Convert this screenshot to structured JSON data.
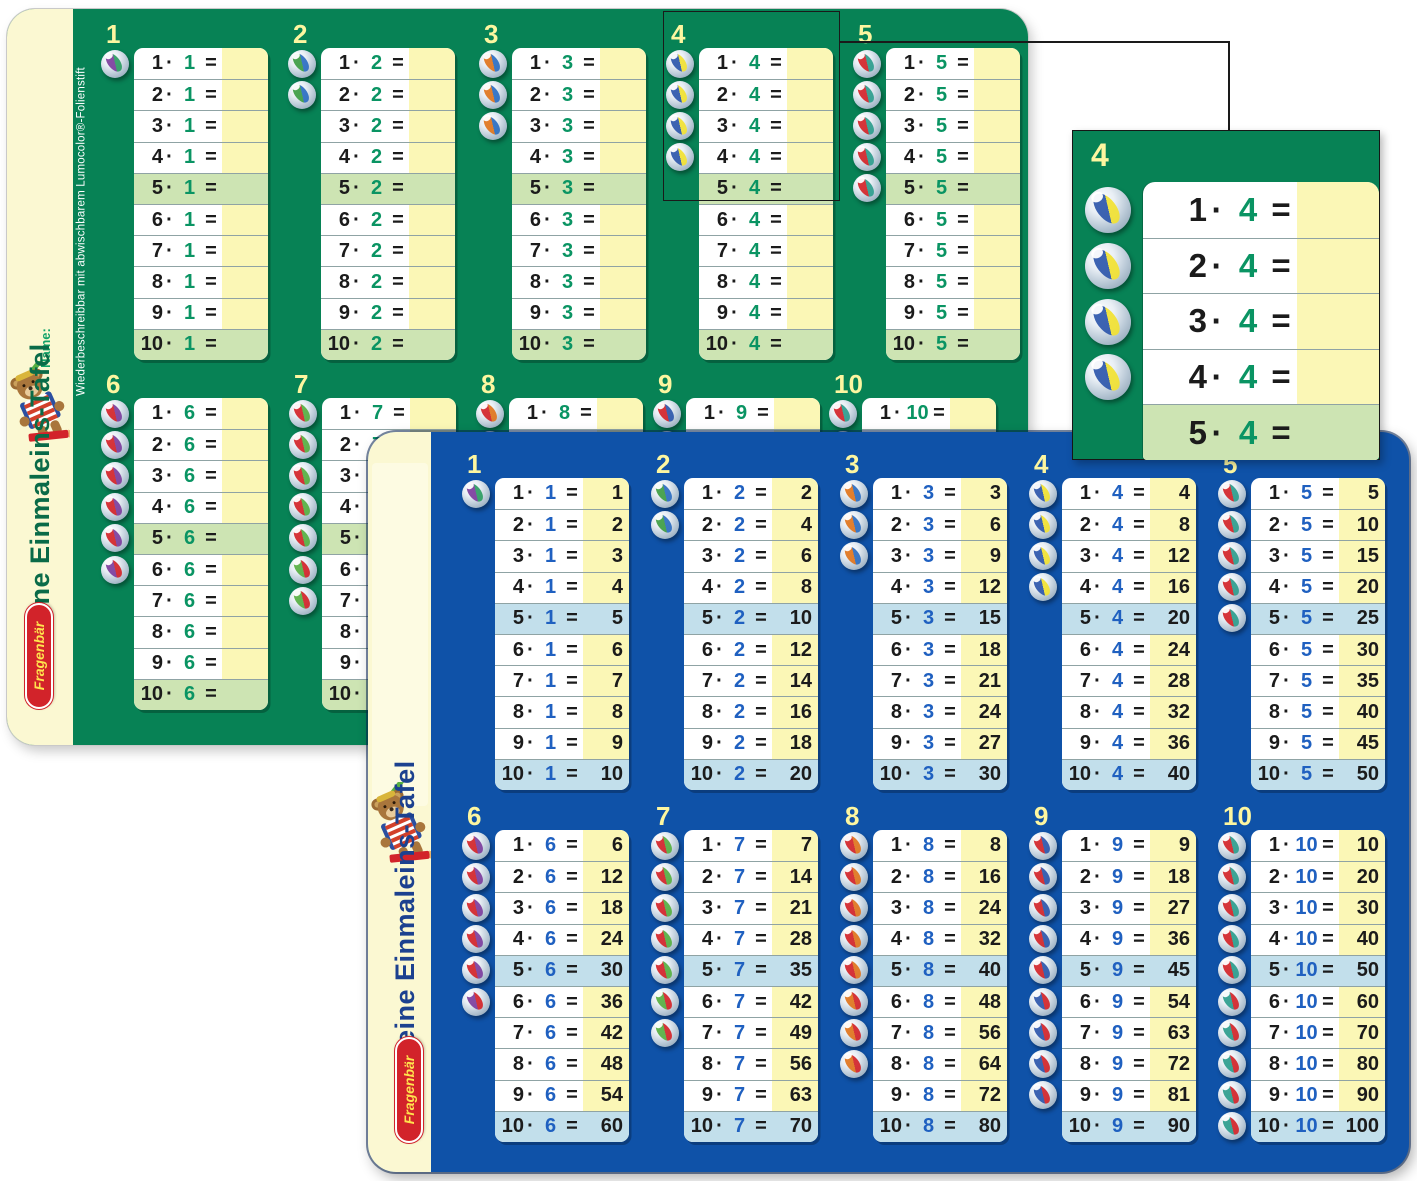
{
  "theme": {
    "green_board_bg": "#078255",
    "blue_board_bg": "#0f52a8",
    "cream_sidebar": "#fbf8d2",
    "answer_cell_yellow": "#fbf7b6",
    "highlight_green": "#cde4b3",
    "highlight_blue": "#c2dfeb",
    "header_number_yellow": "#fdf6a0",
    "factor_green": "#0a9463",
    "factor_blue": "#1f60c0",
    "title_green": "#0a6b48",
    "title_blue": "#1c418f",
    "name_green": "#11a268",
    "logo_red": "#d2232a",
    "logo_text_yellow": "#ffe34d"
  },
  "shared": {
    "operator": "·",
    "equals": "=",
    "multiplicands": [
      "1",
      "2",
      "3",
      "4",
      "5",
      "6",
      "7",
      "8",
      "9",
      "10"
    ],
    "highlighted_multiplicands": [
      "5",
      "10"
    ]
  },
  "green_board": {
    "sidebar": {
      "name_label": "Name:",
      "title": "Kleine Einmaleins-Tafel",
      "logo": "Fragenbär"
    },
    "edge_note": "Wiederbeschreibbar mit abwischbarem Lumocolor®-Folienstift",
    "columns": [
      {
        "header": "1",
        "factor": "1",
        "marbles": 1,
        "marble_colors": [
          "#7d3f9e",
          "#2f9e64"
        ],
        "products": [
          "",
          "",
          "",
          "",
          "",
          "",
          "",
          "",
          "",
          ""
        ]
      },
      {
        "header": "2",
        "factor": "2",
        "marbles": 2,
        "marble_colors": [
          "#3f9e46",
          "#2e6fc2"
        ],
        "products": [
          "",
          "",
          "",
          "",
          "",
          "",
          "",
          "",
          "",
          ""
        ]
      },
      {
        "header": "3",
        "factor": "3",
        "marbles": 3,
        "marble_colors": [
          "#e0761f",
          "#2e6fc2"
        ],
        "products": [
          "",
          "",
          "",
          "",
          "",
          "",
          "",
          "",
          "",
          ""
        ]
      },
      {
        "header": "4",
        "factor": "4",
        "marbles": 4,
        "marble_colors": [
          "#2f58ac",
          "#f2e233"
        ],
        "products": [
          "",
          "",
          "",
          "",
          "",
          "",
          "",
          "",
          "",
          ""
        ]
      },
      {
        "header": "5",
        "factor": "5",
        "marbles": 5,
        "marble_colors": [
          "#d3262b",
          "#2f9e8e"
        ],
        "products": [
          "",
          "",
          "",
          "",
          "",
          "",
          "",
          "",
          "",
          ""
        ]
      },
      {
        "header": "6",
        "factor": "6",
        "marbles": 6,
        "marble_colors": [
          "#d3262b",
          "#7d3f9e"
        ],
        "products": [
          "",
          "",
          "",
          "",
          "",
          "",
          "",
          "",
          "",
          ""
        ]
      },
      {
        "header": "7",
        "factor": "7",
        "marbles": 7,
        "marble_colors": [
          "#d3262b",
          "#58b043"
        ],
        "products": [
          "",
          "",
          "",
          "",
          "",
          "",
          "",
          "",
          "",
          ""
        ]
      },
      {
        "header": "8",
        "factor": "8",
        "marbles": 8,
        "marble_colors": [
          "#d3262b",
          "#e0761f"
        ],
        "products": [
          "",
          "",
          "",
          "",
          "",
          "",
          "",
          "",
          "",
          ""
        ]
      },
      {
        "header": "9",
        "factor": "9",
        "marbles": 9,
        "marble_colors": [
          "#d3262b",
          "#2f58ac"
        ],
        "products": [
          "",
          "",
          "",
          "",
          "",
          "",
          "",
          "",
          "",
          ""
        ]
      },
      {
        "header": "10",
        "factor": "10",
        "marbles": 10,
        "marble_colors": [
          "#d3262b",
          "#2f9e8e"
        ],
        "products": [
          "",
          "",
          "",
          "",
          "",
          "",
          "",
          "",
          "",
          ""
        ]
      }
    ]
  },
  "blue_board": {
    "sidebar": {
      "title": "Kleine Einmaleins-Tafel",
      "logo": "Fragenbär"
    },
    "columns": [
      {
        "header": "1",
        "factor": "1",
        "marbles": 1,
        "marble_colors": [
          "#7d3f9e",
          "#2f9e64"
        ],
        "products": [
          "1",
          "2",
          "3",
          "4",
          "5",
          "6",
          "7",
          "8",
          "9",
          "10"
        ]
      },
      {
        "header": "2",
        "factor": "2",
        "marbles": 2,
        "marble_colors": [
          "#3f9e46",
          "#2e6fc2"
        ],
        "products": [
          "2",
          "4",
          "6",
          "8",
          "10",
          "12",
          "14",
          "16",
          "18",
          "20"
        ]
      },
      {
        "header": "3",
        "factor": "3",
        "marbles": 3,
        "marble_colors": [
          "#e0761f",
          "#2e6fc2"
        ],
        "products": [
          "3",
          "6",
          "9",
          "12",
          "15",
          "18",
          "21",
          "24",
          "27",
          "30"
        ]
      },
      {
        "header": "4",
        "factor": "4",
        "marbles": 4,
        "marble_colors": [
          "#2f58ac",
          "#f2e233"
        ],
        "products": [
          "4",
          "8",
          "12",
          "16",
          "20",
          "24",
          "28",
          "32",
          "36",
          "40"
        ]
      },
      {
        "header": "5",
        "factor": "5",
        "marbles": 5,
        "marble_colors": [
          "#d3262b",
          "#2f9e8e"
        ],
        "products": [
          "5",
          "10",
          "15",
          "20",
          "25",
          "30",
          "35",
          "40",
          "45",
          "50"
        ]
      },
      {
        "header": "6",
        "factor": "6",
        "marbles": 6,
        "marble_colors": [
          "#d3262b",
          "#7d3f9e"
        ],
        "products": [
          "6",
          "12",
          "18",
          "24",
          "30",
          "36",
          "42",
          "48",
          "54",
          "60"
        ]
      },
      {
        "header": "7",
        "factor": "7",
        "marbles": 7,
        "marble_colors": [
          "#d3262b",
          "#58b043"
        ],
        "products": [
          "7",
          "14",
          "21",
          "28",
          "35",
          "42",
          "49",
          "56",
          "63",
          "70"
        ]
      },
      {
        "header": "8",
        "factor": "8",
        "marbles": 8,
        "marble_colors": [
          "#d3262b",
          "#e0761f"
        ],
        "products": [
          "8",
          "16",
          "24",
          "32",
          "40",
          "48",
          "56",
          "64",
          "72",
          "80"
        ]
      },
      {
        "header": "9",
        "factor": "9",
        "marbles": 9,
        "marble_colors": [
          "#d3262b",
          "#2f58ac"
        ],
        "products": [
          "9",
          "18",
          "27",
          "36",
          "45",
          "54",
          "63",
          "72",
          "81",
          "90"
        ]
      },
      {
        "header": "10",
        "factor": "10",
        "marbles": 10,
        "marble_colors": [
          "#d3262b",
          "#2f9e8e"
        ],
        "products": [
          "10",
          "20",
          "30",
          "40",
          "50",
          "60",
          "70",
          "80",
          "90",
          "100"
        ]
      }
    ]
  },
  "inset": {
    "header": "4",
    "factor": "4",
    "marbles": 4,
    "marble_colors": [
      "#2f58ac",
      "#f2e233"
    ],
    "multiplicands": [
      "1",
      "2",
      "3",
      "4",
      "5"
    ],
    "products": [
      "",
      "",
      "",
      "",
      ""
    ]
  }
}
